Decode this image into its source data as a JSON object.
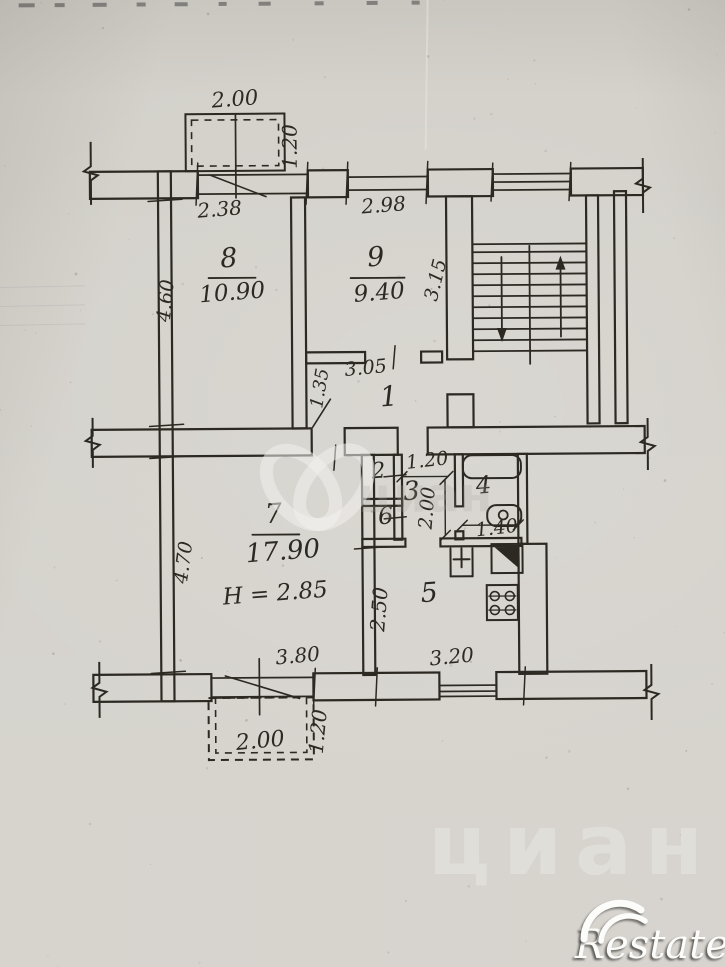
{
  "palette": {
    "paper": "#d4d1cb",
    "ink": "#2c2822",
    "watermark_white": "#f3f1ec"
  },
  "watermarks": {
    "restate_text": "Restate",
    "cian_text": "циан"
  },
  "rooms": [
    {
      "number": "8",
      "area": "10.90",
      "number_pos": [
        231,
        266
      ],
      "number_size": 27,
      "underline": [
        210,
        277,
        257,
        277
      ],
      "area_pos": [
        234,
        299
      ],
      "area_size": 23
    },
    {
      "number": "9",
      "area": "9.40",
      "number_pos": [
        378,
        266
      ],
      "number_size": 27,
      "underline": [
        352,
        278,
        406,
        278
      ],
      "area_pos": [
        381,
        300
      ],
      "area_size": 23
    },
    {
      "number": "1",
      "number_pos": [
        390,
        406
      ],
      "number_size": 28
    },
    {
      "number": "2",
      "number_pos": [
        379,
        478
      ],
      "number_size": 22
    },
    {
      "number": "3",
      "number_pos": [
        412,
        500
      ],
      "number_size": 26
    },
    {
      "number": "4",
      "number_pos": [
        484,
        494
      ],
      "number_size": 24
    },
    {
      "number": "5",
      "number_pos": [
        429,
        602
      ],
      "number_size": 27
    },
    {
      "number": "6",
      "number_pos": [
        386,
        524
      ],
      "number_size": 24
    },
    {
      "number": "7",
      "area": "17.90",
      "number_pos": [
        274,
        522
      ],
      "number_size": 27,
      "underline": [
        252,
        534,
        299,
        534
      ],
      "area_pos": [
        283,
        559
      ],
      "area_size": 26,
      "extra": "H = 2.85",
      "extra_pos": [
        275,
        600
      ],
      "extra_size": 23
    }
  ],
  "dimensions": [
    {
      "text": "2.00",
      "x": 238,
      "y": 105,
      "rot": -4,
      "size": 21
    },
    {
      "text": "1.20",
      "x": 299,
      "y": 146,
      "rot": -90,
      "size": 20
    },
    {
      "text": "2.38",
      "x": 222,
      "y": 215,
      "rot": -4,
      "size": 20
    },
    {
      "text": "2.98",
      "x": 386,
      "y": 212,
      "rot": -4,
      "size": 20
    },
    {
      "text": "3.15",
      "x": 443,
      "y": 282,
      "rot": -76,
      "size": 19
    },
    {
      "text": "4.60",
      "x": 173,
      "y": 300,
      "rot": -84,
      "size": 19
    },
    {
      "text": "1.35",
      "x": 326,
      "y": 389,
      "rot": -80,
      "size": 18
    },
    {
      "text": "3.05",
      "x": 367,
      "y": 374,
      "rot": -5,
      "size": 19
    },
    {
      "text": "1.20",
      "x": 428,
      "y": 467,
      "rot": -6,
      "size": 19
    },
    {
      "text": "2.00",
      "x": 433,
      "y": 509,
      "rot": -85,
      "size": 19
    },
    {
      "text": "1.40",
      "x": 497,
      "y": 535,
      "rot": -6,
      "size": 19
    },
    {
      "text": "2.50",
      "x": 385,
      "y": 610,
      "rot": -85,
      "size": 20
    },
    {
      "text": "4.70",
      "x": 189,
      "y": 562,
      "rot": -82,
      "size": 19
    },
    {
      "text": "3.80",
      "x": 297,
      "y": 662,
      "rot": -5,
      "size": 20
    },
    {
      "text": "3.20",
      "x": 451,
      "y": 664,
      "rot": -5,
      "size": 20
    },
    {
      "text": "2.00",
      "x": 259,
      "y": 747,
      "rot": -5,
      "size": 22
    },
    {
      "text": "1.20",
      "x": 323,
      "y": 732,
      "rot": -84,
      "size": 20
    }
  ],
  "plan": {
    "walls": [
      [
        92,
        170,
        108,
        27
      ],
      [
        310,
        170,
        40,
        27
      ],
      [
        430,
        170,
        65,
        27
      ],
      [
        573,
        170,
        72,
        27
      ],
      [
        160,
        170,
        13,
        530
      ],
      [
        293,
        197,
        14,
        231
      ],
      [
        307,
        352,
        59,
        11
      ],
      [
        422,
        352,
        21,
        11
      ],
      [
        448,
        197,
        26,
        163
      ],
      [
        448,
        395,
        26,
        33
      ],
      [
        588,
        197,
        12,
        228
      ],
      [
        616,
        193,
        12,
        232
      ],
      [
        92,
        428,
        220,
        27
      ],
      [
        345,
        428,
        53,
        27
      ],
      [
        428,
        428,
        217,
        27
      ],
      [
        362,
        455,
        12,
        220
      ],
      [
        394,
        455,
        8,
        85
      ],
      [
        362,
        499,
        40,
        7
      ],
      [
        455,
        455,
        8,
        52
      ],
      [
        455,
        532,
        8,
        8
      ],
      [
        518,
        455,
        9,
        90
      ],
      [
        518,
        545,
        28,
        130
      ],
      [
        362,
        539,
        43,
        8
      ],
      [
        440,
        539,
        81,
        8
      ],
      [
        92,
        673,
        118,
        27
      ],
      [
        312,
        673,
        126,
        27
      ],
      [
        495,
        673,
        150,
        27
      ]
    ],
    "window_lines": [
      [
        200,
        174,
        310,
        174
      ],
      [
        200,
        193,
        310,
        193
      ],
      [
        350,
        177,
        430,
        177
      ],
      [
        350,
        190,
        430,
        190
      ],
      [
        495,
        175,
        573,
        175
      ],
      [
        495,
        183,
        573,
        183
      ],
      [
        495,
        191,
        573,
        191
      ],
      [
        210,
        677,
        312,
        677
      ],
      [
        210,
        696,
        312,
        696
      ],
      [
        438,
        686,
        495,
        686
      ],
      [
        438,
        692,
        495,
        692
      ],
      [
        438,
        697,
        495,
        697
      ],
      [
        238,
        113,
        238,
        197
      ],
      [
        258,
        658,
        258,
        714
      ]
    ],
    "diagonals": [
      [
        212,
        174,
        268,
        196
      ],
      [
        224,
        675,
        298,
        698
      ],
      [
        313,
        427,
        331,
        399
      ]
    ],
    "balconies": [
      {
        "outer": [
          188,
          113,
          99,
          57
        ],
        "outer_style": "solid",
        "inner": [
          194,
          119,
          87,
          46
        ]
      },
      {
        "outer": [
          207,
          697,
          105,
          62
        ],
        "outer_style": "dashed",
        "inner": [
          214,
          697,
          91,
          55
        ]
      }
    ],
    "breaks": [
      [
        93,
        140,
        203
      ],
      [
        645,
        160,
        215
      ],
      [
        648,
        420,
        472
      ],
      [
        650,
        666,
        722
      ],
      [
        98,
        660,
        716
      ],
      [
        93,
        416,
        466
      ]
    ],
    "ticks": [
      [
        200,
        162,
        198,
        204
      ],
      [
        310,
        162,
        308,
        204
      ],
      [
        350,
        162,
        348,
        204
      ],
      [
        430,
        162,
        428,
        204
      ],
      [
        495,
        164,
        493,
        202
      ],
      [
        573,
        164,
        571,
        202
      ],
      [
        150,
        200,
        184,
        198
      ],
      [
        150,
        425,
        184,
        423
      ],
      [
        150,
        457,
        184,
        455
      ],
      [
        150,
        672,
        184,
        670
      ],
      [
        396,
        346,
        394,
        369
      ],
      [
        336,
        445,
        334,
        470
      ],
      [
        384,
        477,
        406,
        475
      ],
      [
        384,
        519,
        406,
        517
      ],
      [
        314,
        668,
        312,
        706
      ],
      [
        376,
        668,
        374,
        706
      ],
      [
        524,
        668,
        522,
        706
      ],
      [
        354,
        549,
        384,
        547
      ]
    ],
    "dim_lines": [
      [
        402,
        477,
        448,
        477
      ],
      [
        445,
        480,
        445,
        536
      ],
      [
        462,
        526,
        518,
        526
      ]
    ],
    "stairs": {
      "x1": 474,
      "x2": 588,
      "step_ys": [
        245,
        253,
        264,
        275,
        286,
        297,
        308,
        319,
        330,
        341,
        352
      ],
      "divider": [
        531,
        247,
        531,
        365
      ],
      "arrows": [
        {
          "shaft": [
            503,
            258,
            503,
            336
          ],
          "head": [
            [
              503,
              343
            ],
            [
              498,
              329
            ],
            [
              508,
              329
            ]
          ]
        },
        {
          "shaft": [
            562,
            338,
            562,
            264
          ],
          "head": [
            [
              562,
              257
            ],
            [
              557,
              271
            ],
            [
              567,
              271
            ]
          ]
        }
      ]
    },
    "fixtures": {
      "bathtub": {
        "rect": [
          463,
          456,
          58,
          23
        ],
        "rx": 9
      },
      "washbasin": {
        "rect": [
          487,
          506,
          34,
          21
        ],
        "rx": 9,
        "circle": [
          503,
          516,
          4.5
        ]
      },
      "kitchen_sink": {
        "lines": [
          [
            450,
            549,
            450,
            577
          ],
          [
            472,
            549,
            472,
            577
          ],
          [
            450,
            577,
            472,
            577
          ],
          [
            461,
            549,
            461,
            568
          ],
          [
            453,
            560,
            469,
            560
          ]
        ]
      },
      "sink_unit": {
        "rect": [
          491,
          545,
          31,
          29
        ],
        "triangle": [
          [
            494,
            548
          ],
          [
            519,
            548
          ],
          [
            519,
            570
          ]
        ]
      },
      "stove": {
        "rect": [
          486,
          586,
          31,
          35
        ],
        "row_lines": [
          [
            488,
            597,
            515,
            597
          ],
          [
            488,
            611,
            515,
            611
          ]
        ],
        "burners": [
          [
            494,
            597
          ],
          [
            509,
            597
          ],
          [
            494,
            611
          ],
          [
            509,
            611
          ]
        ],
        "burner_r": 4.5
      }
    },
    "heart_logo": {
      "cx1": 301,
      "cx2": 334,
      "cy": 487,
      "rx": 27,
      "ry": 43,
      "tilt": 40
    },
    "faint_cian": {
      "x": 425,
      "y": 512,
      "size": 48
    }
  }
}
